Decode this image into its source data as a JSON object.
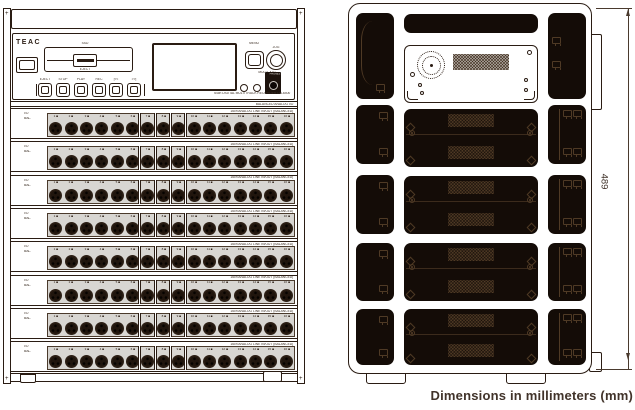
{
  "caption": "Dimensions in millimeters (mm)",
  "colors": {
    "ink": "#2a1c13",
    "panel_gray": "#d8d6d2",
    "dark_fill": "#140c07"
  },
  "front": {
    "brand": "TEAC",
    "drive_label": "SSD",
    "eject_label": "EJECT",
    "transport_labels": [
      "EJECT",
      "STOP",
      "PLAY",
      "REC",
      "|<<",
      ">>|"
    ],
    "knob_label_left": "MENU",
    "knob_label_right": "JOG",
    "knob_caption": "MULTI JOG",
    "indicator_labels": [
      "STATUS",
      "REMOTE"
    ],
    "phones_label": "PHONES",
    "model_line": "64ch DIGITAL MULTITRACK RECORDER DA-6400",
    "spacer_label": "BALANCED ANALOG I/O",
    "rows": {
      "count": 8,
      "left_label_line1": "I/O",
      "left_label_line2": "BAL.",
      "header_text": "16ch ANALOG LINE IN/OUT (BALANCED)",
      "channel_numbers": [
        "1",
        "2",
        "3",
        "4",
        "5",
        "6",
        "7",
        "8",
        "9",
        "10",
        "11",
        "12",
        "13",
        "14",
        "15",
        "16"
      ],
      "group_breaks_after": [
        6,
        7,
        8,
        9
      ]
    }
  },
  "rear": {
    "dimension_label": "489",
    "left_module_count": 5,
    "right_module_count": 5,
    "center_module_count": 6
  }
}
